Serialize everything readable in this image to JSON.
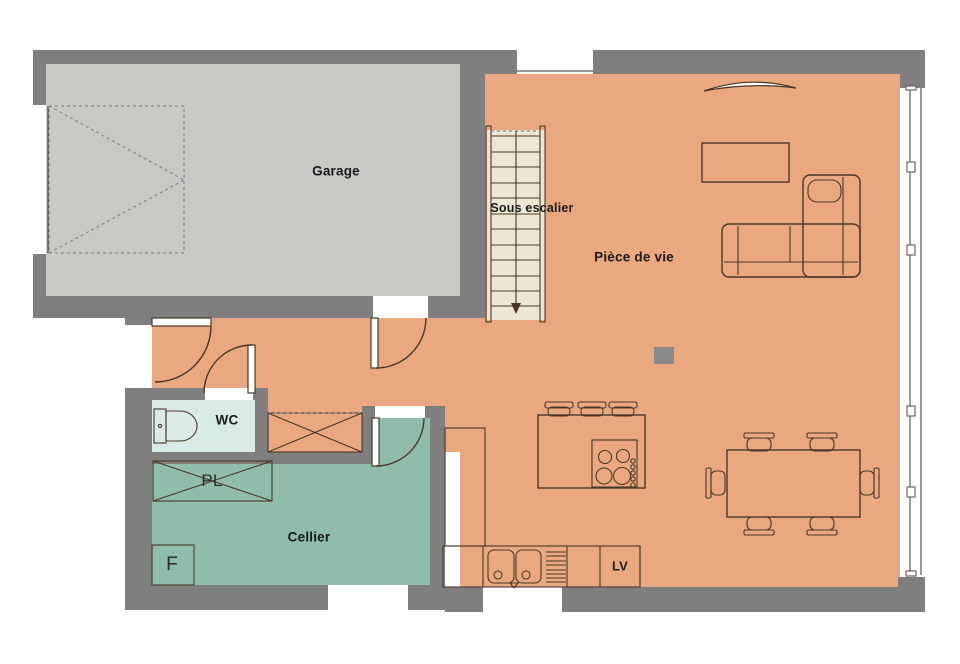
{
  "colors": {
    "wall": "#7f7f7f",
    "garage-floor": "#c9c9c5",
    "main-floor": "#e9a87f",
    "cellier-floor": "#8fbcab",
    "wc-floor": "#d8ebe6",
    "stairs": "#ece7d5",
    "line": "#4a3826",
    "dash": "#8a8a8a",
    "post": "#8a8a8a",
    "text": "#1b1b1b"
  },
  "rooms": {
    "garage": {
      "label": "Garage"
    },
    "piece_de_vie": {
      "label": "Pièce de vie"
    },
    "sous_escalier": {
      "label": "Sous escalier"
    },
    "wc": {
      "label": "WC"
    },
    "cellier": {
      "label": "Cellier"
    }
  },
  "fixtures": {
    "placard": {
      "label": "PL"
    },
    "fridge": {
      "label": "F"
    },
    "dishwasher": {
      "label": "LV"
    }
  }
}
